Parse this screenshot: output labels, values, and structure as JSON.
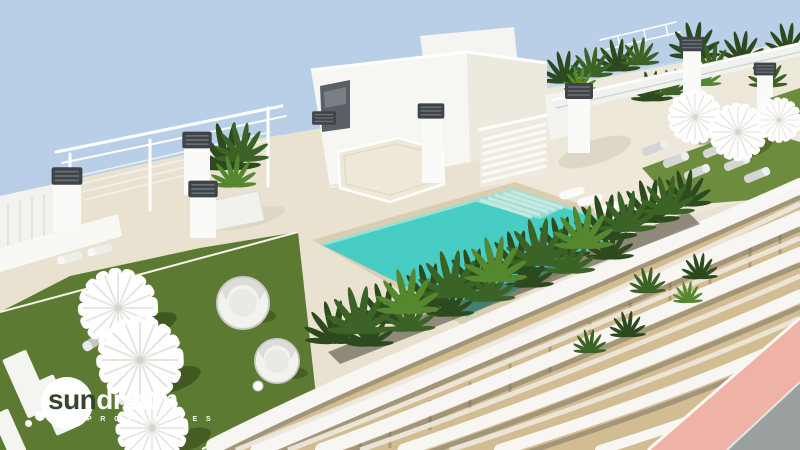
{
  "scene": {
    "alt": "Aerial 3D architectural rendering of a rooftop terrace on a modern white apartment building: turquoise swimming pool with submerged loungers, tropical planters, artificial lawns with round palapa parasols, daybeds and sun loungers, white pergolas and stair towers, wavy white balcony facade, pink pavement street corner"
  },
  "logo": {
    "word_sun": "sun",
    "word_dream": "dream",
    "subtitle": "P R O P E R T I E S"
  },
  "colors": {
    "sky": "#b9cfe8",
    "deck": "#eae2d1",
    "structure_white": "#f6f6f3",
    "structure_shade": "#e9e7dd",
    "glass_dark": "#5a6065",
    "vent_cap": "#3f4448",
    "pool_water": "#48cdc4",
    "pool_steps": "#c9e9e2",
    "pool_coping": "#d9cdb2",
    "lawn_left": "#5c7a31",
    "lawn_right": "#6d8c3d",
    "plant_dark": "#2c4a1e",
    "plant_mid": "#3c6326",
    "plant_light": "#55872f",
    "umbrella": "#ffffff",
    "lounger_gray": "#c4c6c4",
    "glass_balustrade": "#c8d8d8",
    "facade_white": "#f7f6f2",
    "facade_wood": "#d2bd92",
    "facade_shadow": "#6b655c",
    "street_pink": "#eeb2a6",
    "street_gray": "#9aa0a0",
    "logo_white": "#ffffff",
    "logo_knockout": "#37452c"
  }
}
